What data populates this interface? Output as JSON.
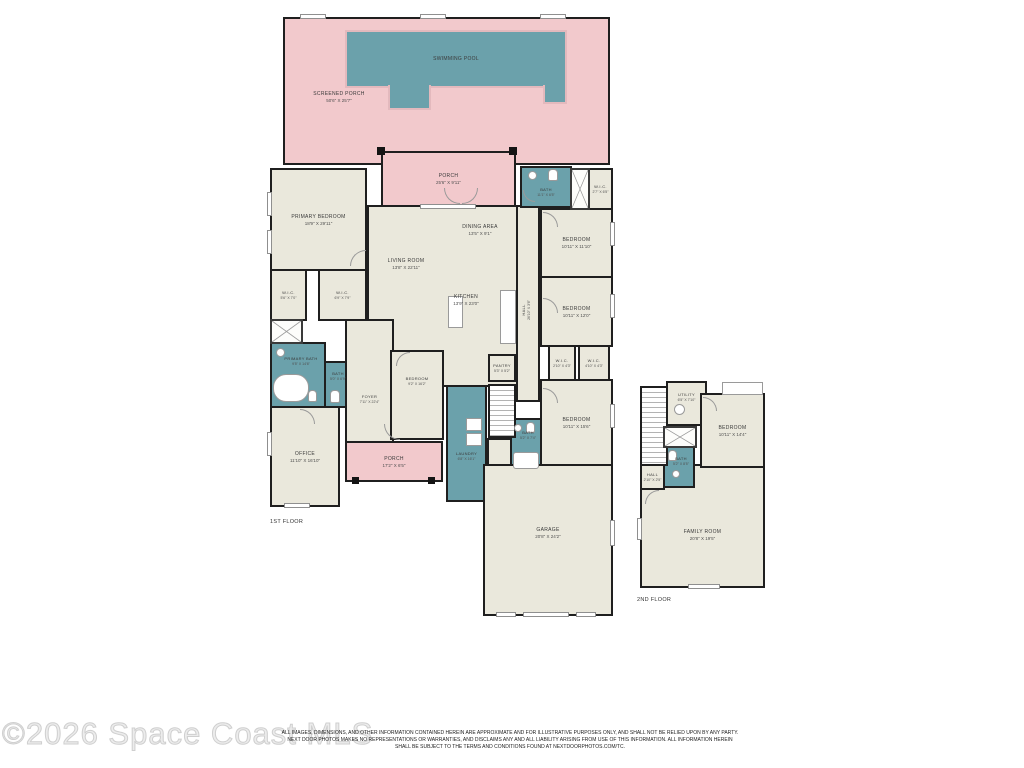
{
  "page": {
    "floor1_label": "1ST FLOOR",
    "floor2_label": "2ND FLOOR",
    "watermark": "©2026 Space Coast MLS",
    "disclaimer": [
      "ALL IMAGES, DIMENSIONS, AND OTHER INFORMATION CONTAINED HEREIN ARE APPROXIMATE AND FOR ILLUSTRATIVE PURPOSES ONLY, AND SHALL NOT BE RELIED UPON BY ANY PARTY.",
      "NEXT DOOR PHOTOS MAKES NO REPRESENTATIONS OR WARRANTIES, AND DISCLAIMS ANY AND ALL LIABILITY ARISING FROM USE OF THIS INFORMATION. ALL INFORMATION HEREIN",
      "SHALL BE SUBJECT TO THE TERMS AND CONDITIONS FOUND AT NEXTDOORPHOTOS.COM/TC."
    ]
  },
  "colors": {
    "room_fill": "#eae8dc",
    "porch_fill": "#f2c9cc",
    "water_fill": "#6ba1ab",
    "wall": "#1f1f1f",
    "label_text": "#3a3a3a",
    "watermark_gray": "#dcdcdc"
  },
  "rooms": {
    "screened_porch": {
      "name": "SCREENED PORCH",
      "dims": "50'6\" X 25'7\""
    },
    "swimming_pool": {
      "name": "SWIMMING POOL",
      "dims": ""
    },
    "porch_top": {
      "name": "PORCH",
      "dims": "25'6\" X 9'11\""
    },
    "primary_bedroom": {
      "name": "PRIMARY BEDROOM",
      "dims": "18'9\" X 29'11\""
    },
    "wic_primary_left": {
      "name": "W.I.C.",
      "dims": "5'6\" X 7'0\""
    },
    "wic_primary_right": {
      "name": "W.I.C.",
      "dims": "6'9\" X 7'9\""
    },
    "primary_bath": {
      "name": "PRIMARY BATH",
      "dims": "9'5\" X 14'6\""
    },
    "bath_hall": {
      "name": "BATH",
      "dims": "5'0\" X 6'9\""
    },
    "office": {
      "name": "OFFICE",
      "dims": "11'10\" X 16'10\""
    },
    "foyer": {
      "name": "FOYER",
      "dims": "7'11\" X 22'4\""
    },
    "porch_front": {
      "name": "PORCH",
      "dims": "17'2\" X 6'5\""
    },
    "living_room": {
      "name": "LIVING ROOM",
      "dims": "13'8\" X 22'11\""
    },
    "dining_area": {
      "name": "DINING AREA",
      "dims": "13'5\" X 9'1\""
    },
    "kitchen": {
      "name": "KITCHEN",
      "dims": "13'9\" X 23'0\""
    },
    "pantry": {
      "name": "PANTRY",
      "dims": "5'3\" X 5'2\""
    },
    "bedroom_center": {
      "name": "BEDROOM",
      "dims": "9'2\" X 16'2\""
    },
    "laundry": {
      "name": "LAUNDRY",
      "dims": "6'8\" X 16'1\""
    },
    "hall_main": {
      "name": "HALL",
      "dims": "26'10\" X 3'6\""
    },
    "bath_ne": {
      "name": "BATH",
      "dims": "11'1\" X 6'5\""
    },
    "wic_ne": {
      "name": "W.I.C.",
      "dims": "2'7\" X 6'5\""
    },
    "bedroom_ne": {
      "name": "BEDROOM",
      "dims": "10'11\" X 11'10\""
    },
    "bedroom_e": {
      "name": "BEDROOM",
      "dims": "10'11\" X 12'0\""
    },
    "wic_e_left": {
      "name": "W.I.C.",
      "dims": "2'10\" X 4'3\""
    },
    "wic_e_right": {
      "name": "W.I.C.",
      "dims": "4'10\" X 4'3\""
    },
    "bedroom_se": {
      "name": "BEDROOM",
      "dims": "10'11\" X 15'6\""
    },
    "bath_se": {
      "name": "BATH",
      "dims": "5'2\" X 7'4\""
    },
    "garage": {
      "name": "GARAGE",
      "dims": "20'8\" X 24'2\""
    },
    "utility": {
      "name": "UTILITY",
      "dims": "6'5\" X 7'10\""
    },
    "bedroom_2f": {
      "name": "BEDROOM",
      "dims": "10'11\" X 14'4\""
    },
    "bath_2f": {
      "name": "BATH",
      "dims": "5'2\" X 8'5\""
    },
    "hall_2f": {
      "name": "HALL",
      "dims": "2'10\" X 2'5\""
    },
    "family_room": {
      "name": "FAMILY ROOM",
      "dims": "20'8\" X 19'5\""
    }
  }
}
